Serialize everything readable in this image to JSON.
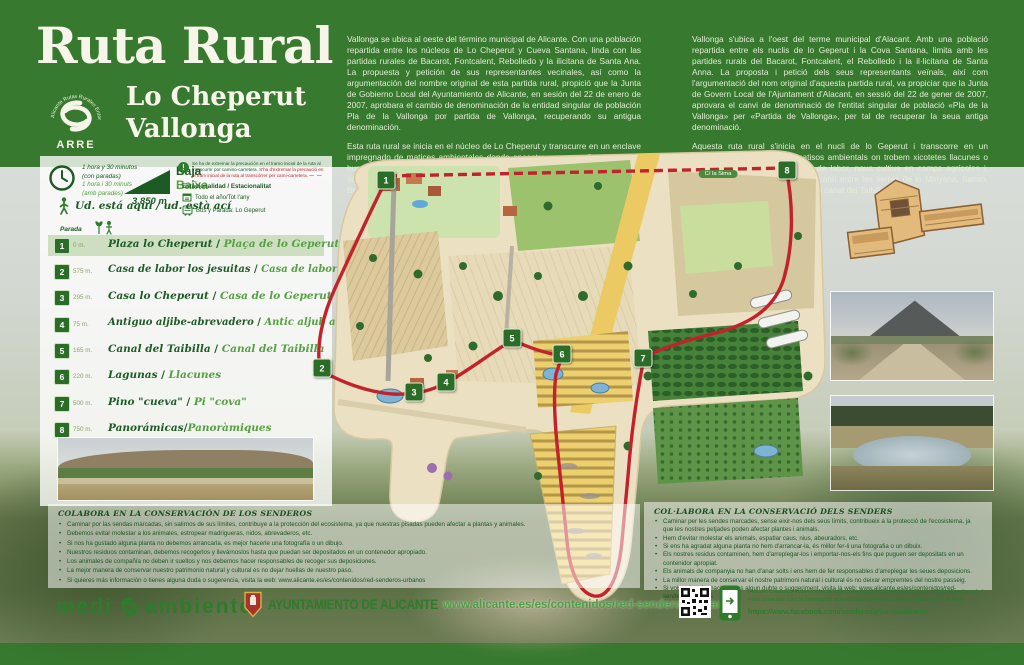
{
  "header": {
    "title": "Ruta Rural",
    "subtitle1": "Lo Cheperut",
    "subtitle2": "Vallonga",
    "logo": {
      "arc": "Alicante Rutas Rurales Entorno",
      "acronym": "ARRE"
    },
    "intro_es_p1": "Vallonga se ubica al oeste del término municipal de Alicante. Con una población repartida entre los núcleos de Lo Cheperut y Cueva Santana, linda con las partidas rurales de Bacarot, Fontcalent, Rebolledo y la ilicitana de Santa Ana. La propuesta y petición de sus representantes vecinales, así como la argumentación del nombre original de esta partida rural, propició que la Junta de Gobierno Local del Ayuntamiento de Alicante, en sesión del 22 de enero de 2007, aprobara el cambio de denominación de la entidad singular de población Pla de la Vallonga por partida de Vallonga, recuperando su antigua denominación.",
    "intro_es_p2": "Esta ruta rural se inicia en el núcleo de Lo Cheperut y transcurre en un enclave impregnado de matices ambientales donde encontramos pequeñas lagunas o humedales, antiguas casas de labor, nuevos cultivos en campos agrícolas y, sobre todo, un singular paisaje alicantino entre las sierras de Miñana, Sancho, Borbuño y Foncalent, atravesado por el canal del Taibilla.",
    "intro_va_p1": "Vallonga s'ubica a l'oest del terme municipal d'Alacant. Amb una població repartida entre els nuclis de lo Geperut i la Cova Santana, limita amb les partides rurals del Bacarot, Fontcalent, el Rebolledo i la il·licitana de Santa Anna. La proposta i petició dels seus representants veïnals, així com l'argumentació del nom original d'aquesta partida rural, va propiciar que la Junta de Govern Local de l'Ajuntament d'Alacant, en sessió del 22 de gener de 2007, aprovara el canvi de denominació de l'entitat singular de població «Pla de la Vallonga» per «Partida de Vallonga», per tal de recuperar la seua antiga denominació.",
    "intro_va_p2": "Aquesta ruta rural s'inicia en el nucli de lo Geperut i transcorre en un enclavament impregnat de matisos ambientals on trobem xicotetes llacunes o zones humides, antigues cases de labor, nous cultius en camps agrícoles i, sobretot, un singular paisatge alacantí entre les serres de lo Minyana, Sanxo, Borbunyó i Foncalent, travessat pel canal del Taibilla."
  },
  "info": {
    "time_es1": "1 hora y 30 minutos",
    "time_es2": "(con paradas)",
    "time_va1": "1 hora i 30 minuts",
    "time_va2": "(amb parades)",
    "difficulty_es": "Baja",
    "difficulty_va": "Baixa",
    "distance": "3.850 m",
    "warning_es": "Se ha de extremar la precaución en el tramo inicial de la ruta al transcurrir por camino-carretera.",
    "warning_va": "S'ha d'extremar la precaució en el tram inicial de la ruta al transcórrer per camí-carretera.",
    "route_line_sample": "— — —",
    "seasonality_label": "Estacionalidad / Estacionalitat",
    "season_value": "Todo el año/Tot l'any",
    "bus_value": "Bus y Parada: Lo Geperut",
    "you_are_here": "Ud. está aquí / ud. està ací",
    "stops_label": "Parada"
  },
  "stops": [
    {
      "num": "1",
      "dist": "0 m.",
      "name_es": "Plaza lo Cheperut",
      "name_va": "Plaça de lo Geperut"
    },
    {
      "num": "2",
      "dist": "575 m.",
      "name_es": "Casa de labor los jesuitas",
      "name_va": "Casa de labor dels jesuites"
    },
    {
      "num": "3",
      "dist": "295 m.",
      "name_es": "Casa lo Cheperut",
      "name_va": "Casa de lo Geperut"
    },
    {
      "num": "4",
      "dist": "75 m.",
      "name_es": "Antiguo aljibe-abrevadero",
      "name_va": "Antic aljub abeurador"
    },
    {
      "num": "5",
      "dist": "165 m.",
      "name_es": "Canal del Taibilla",
      "name_va": "Canal del Taibilla"
    },
    {
      "num": "6",
      "dist": "220 m.",
      "name_es": "Lagunas",
      "name_va": "Llacunes"
    },
    {
      "num": "7",
      "dist": "500 m.",
      "name_es": "Pino \"cueva\"",
      "name_va": "Pi \"cova\""
    },
    {
      "num": "8",
      "dist": "750 m.",
      "name_es": "Panorámicas",
      "name_va": "Panoràmiques"
    }
  ],
  "map": {
    "road_label": "C/ la Sima",
    "markers": [
      "1",
      "2",
      "3",
      "4",
      "5",
      "6",
      "7",
      "8"
    ]
  },
  "conservation_es": {
    "title": "COLABORA EN LA CONSERVACIÓN DE LOS SENDEROS",
    "bullets": [
      "Caminar por las sendas marcadas, sin salirnos de sus límites, contribuye a la protección del ecosistema, ya que nuestras pisadas pueden afectar a plantas y animales.",
      "Debemos evitar molestar a los animales, estropear madrigueras, nidos, abrevaderos, etc.",
      "Si nos ha gustado alguna planta no debemos arrancarla, es mejor hacerle una fotografía o un dibujo.",
      "Nuestros residuos contaminan, debemos recogerlos y llevárnoslos hasta que puedan ser depositados en un contenedor apropiado.",
      "Los animales de compañía no deben ir sueltos y nos debemos hacer responsables de recoger sus deposiciones.",
      "La mejor manera de conservar nuestro patrimonio natural y cultural es no dejar huellas de nuestro paso.",
      "Si quieres más información o tienes alguna duda o sugerencia, visita la web: www.alicante.es/es/contenidos/red-senderos-urbanos"
    ]
  },
  "conservation_va": {
    "title": "COL·LABORA EN LA CONSERVACIÓ DELS SENDERS",
    "bullets": [
      "Caminar per les sendes marcades, sense eixir-nos dels seus límits, contribueix a la protecció de l'ecosistema, ja que les nostres petjades poden afectar plantes i animals.",
      "Hem d'evitar molestar els animals, espatlar caus, nius, abeuradors, etc.",
      "Si ens ha agradat alguna planta no hem d'arrancar-la, és millor fer-li una fotografia o un dibuix.",
      "Els nostres residus contaminen, hem d'arreplegar-los i emportar-nos-els fins que puguen ser depositats en un contenidor apropiat.",
      "Els animals de companyia no han d'anar solts i ens hem de fer responsables d'arreplegar les seues deposicions.",
      "La millor manera de conservar el nostre patrimoni natural i cultural és no deixar empremtes del nostre passeig.",
      "Si vols més informació o tens algun dubte o suggeriment, visita la web: www.alicante.es/es/contenidos/red-senderos-urbanos"
    ]
  },
  "footer": {
    "medio_word1": "medi",
    "medio_word2": "ambiente",
    "ayuntamiento": "AYUNTAMIENTO DE ALICANTE",
    "url": "www.alicante.es/es/contenidos/red-senderos-urbanos",
    "note_es": "Puedes consultar toda la información actualizada sobre los Senderos Urbanos en la web /",
    "note_va": "Pots consultar tota la informació actualitzada sobre les Sendes Urbanes en la web:",
    "facebook": "https://www.facebook.com/senderosurbanosalicante"
  }
}
